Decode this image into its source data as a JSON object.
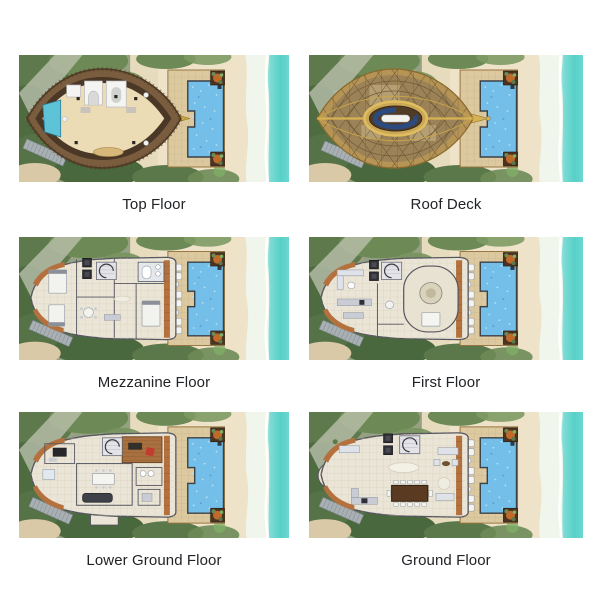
{
  "tiles": [
    {
      "id": "top-floor",
      "label": "Top Floor"
    },
    {
      "id": "roof-deck",
      "label": "Roof Deck"
    },
    {
      "id": "mezzanine-floor",
      "label": "Mezzanine Floor"
    },
    {
      "id": "first-floor",
      "label": "First Floor"
    },
    {
      "id": "lower-ground-floor",
      "label": "Lower Ground Floor"
    },
    {
      "id": "ground-floor",
      "label": "Ground Floor"
    }
  ],
  "palette": {
    "page_background": "#ffffff",
    "caption_text": "#212326",
    "ocean": "#5ed2cb",
    "surf_foam": "#f1f6ec",
    "beach_sand": "#e7dbbd",
    "foliage_green": "#5e7a4c",
    "deck_tan": "#dcc9a0",
    "pool_blue": "#74bfe9",
    "wood_brown": "#b4713e",
    "roof_gold": "#c9a53f",
    "roof_mesh": "#9c8257",
    "plan_floor": "#eae5d6",
    "plan_wall": "#55555f"
  }
}
